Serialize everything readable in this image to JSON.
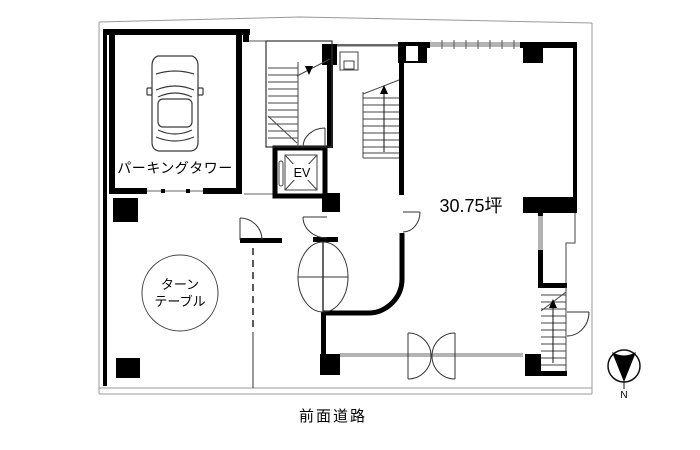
{
  "plan": {
    "labels": {
      "parking_tower": "パーキングタワー",
      "turntable_line1": "ターン",
      "turntable_line2": "テーブル",
      "elevator": "EV",
      "area": "30.75坪",
      "front_road": "前面道路",
      "compass_north": "N"
    },
    "icons": {
      "car_icon": "sedan-top-view",
      "compass_icon": "north-arrow-in-circle"
    },
    "colors": {
      "walls": "#000000",
      "site_boundary": "#999999",
      "window_glass": "#b3b3b3",
      "thin_lines": "#555555",
      "background": "#ffffff"
    }
  }
}
